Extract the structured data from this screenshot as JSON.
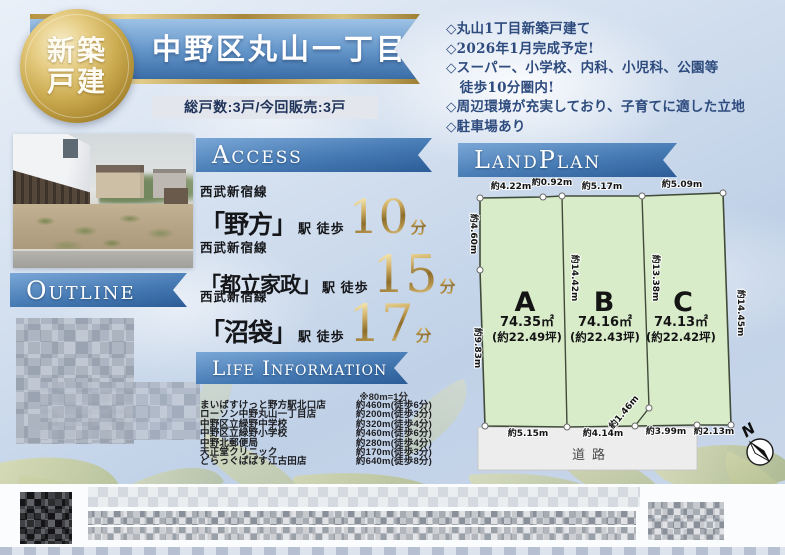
{
  "colors": {
    "ribbon_blue": "#3f6ea8",
    "title_gold": "#c9a84c",
    "accent_gold_text": "#9e7d33",
    "lot_green": "#d9ecca",
    "highlight_text_navy": "#2e4b7e",
    "road_gray": "#ededed"
  },
  "badge": {
    "line1": "新築",
    "line2": "戸建"
  },
  "header": {
    "title": "中野区丸山一丁目",
    "units_info": "総戸数:3戸/今回販売:3戸"
  },
  "highlights": {
    "lines": [
      "◇丸山1丁目新築戸建て",
      "◇2026年1月完成予定!",
      "◇スーパー、小学校、内科、小児科、公園等",
      "　徒歩10分圏内!",
      "◇周辺環境が充実しており、子育てに適した立地",
      "◇駐車場あり"
    ]
  },
  "access": {
    "heading": "Access",
    "routes": [
      {
        "line": "西武新宿線",
        "station": "「野方」",
        "label": "駅 徒歩",
        "minutes": "10",
        "unit": "分"
      },
      {
        "line": "西武新宿線",
        "station": "「都立家政」",
        "label": "駅 徒歩",
        "minutes": "15",
        "unit": "分"
      },
      {
        "line": "西武新宿線",
        "station": "「沼袋」",
        "label": "駅 徒歩",
        "minutes": "17",
        "unit": "分"
      }
    ]
  },
  "outline": {
    "heading": "Outline"
  },
  "life_information": {
    "heading": "Life Information",
    "note": "※80m=1分",
    "facilities": [
      {
        "name": "まいばすけっと野方駅北口店",
        "distance": "約460m(徒歩6分)"
      },
      {
        "name": "ローソン中野丸山一丁目店",
        "distance": "約200m(徒歩3分)"
      },
      {
        "name": "中野区立緑野中学校",
        "distance": "約320m(徒歩4分)"
      },
      {
        "name": "中野区立緑野小学校",
        "distance": "約460m(徒歩6分)"
      },
      {
        "name": "中野北郵便局",
        "distance": "約280m(徒歩4分)"
      },
      {
        "name": "天正堂クリニック",
        "distance": "約170m(徒歩3分)"
      },
      {
        "name": "どらっぐぱぱす江古田店",
        "distance": "約640m(徒歩8分)"
      }
    ]
  },
  "land_plan": {
    "heading": "LandPlan",
    "lots": [
      {
        "name": "A",
        "area_m2": "74.35㎡",
        "area_tsubo": "(約22.49坪)"
      },
      {
        "name": "B",
        "area_m2": "74.16㎡",
        "area_tsubo": "(約22.43坪)"
      },
      {
        "name": "C",
        "area_m2": "74.13㎡",
        "area_tsubo": "(約22.42坪)"
      }
    ],
    "measurements": {
      "top_a": "約4.22m",
      "top_ab": "約0.92m",
      "top_b": "約5.17m",
      "top_c": "約5.09m",
      "left_upper": "約4.60m",
      "left_lower": "約9.83m",
      "inner_ab": "約14.42m",
      "inner_bc": "約13.38m",
      "right_side": "約14.45m",
      "diagonal": "約1.46m",
      "bottom_a": "約5.15m",
      "bottom_b": "約4.14m",
      "bottom_c": "約3.99m",
      "bottom_right": "約2.13m"
    },
    "road_label": "道路",
    "compass_label": "N"
  }
}
